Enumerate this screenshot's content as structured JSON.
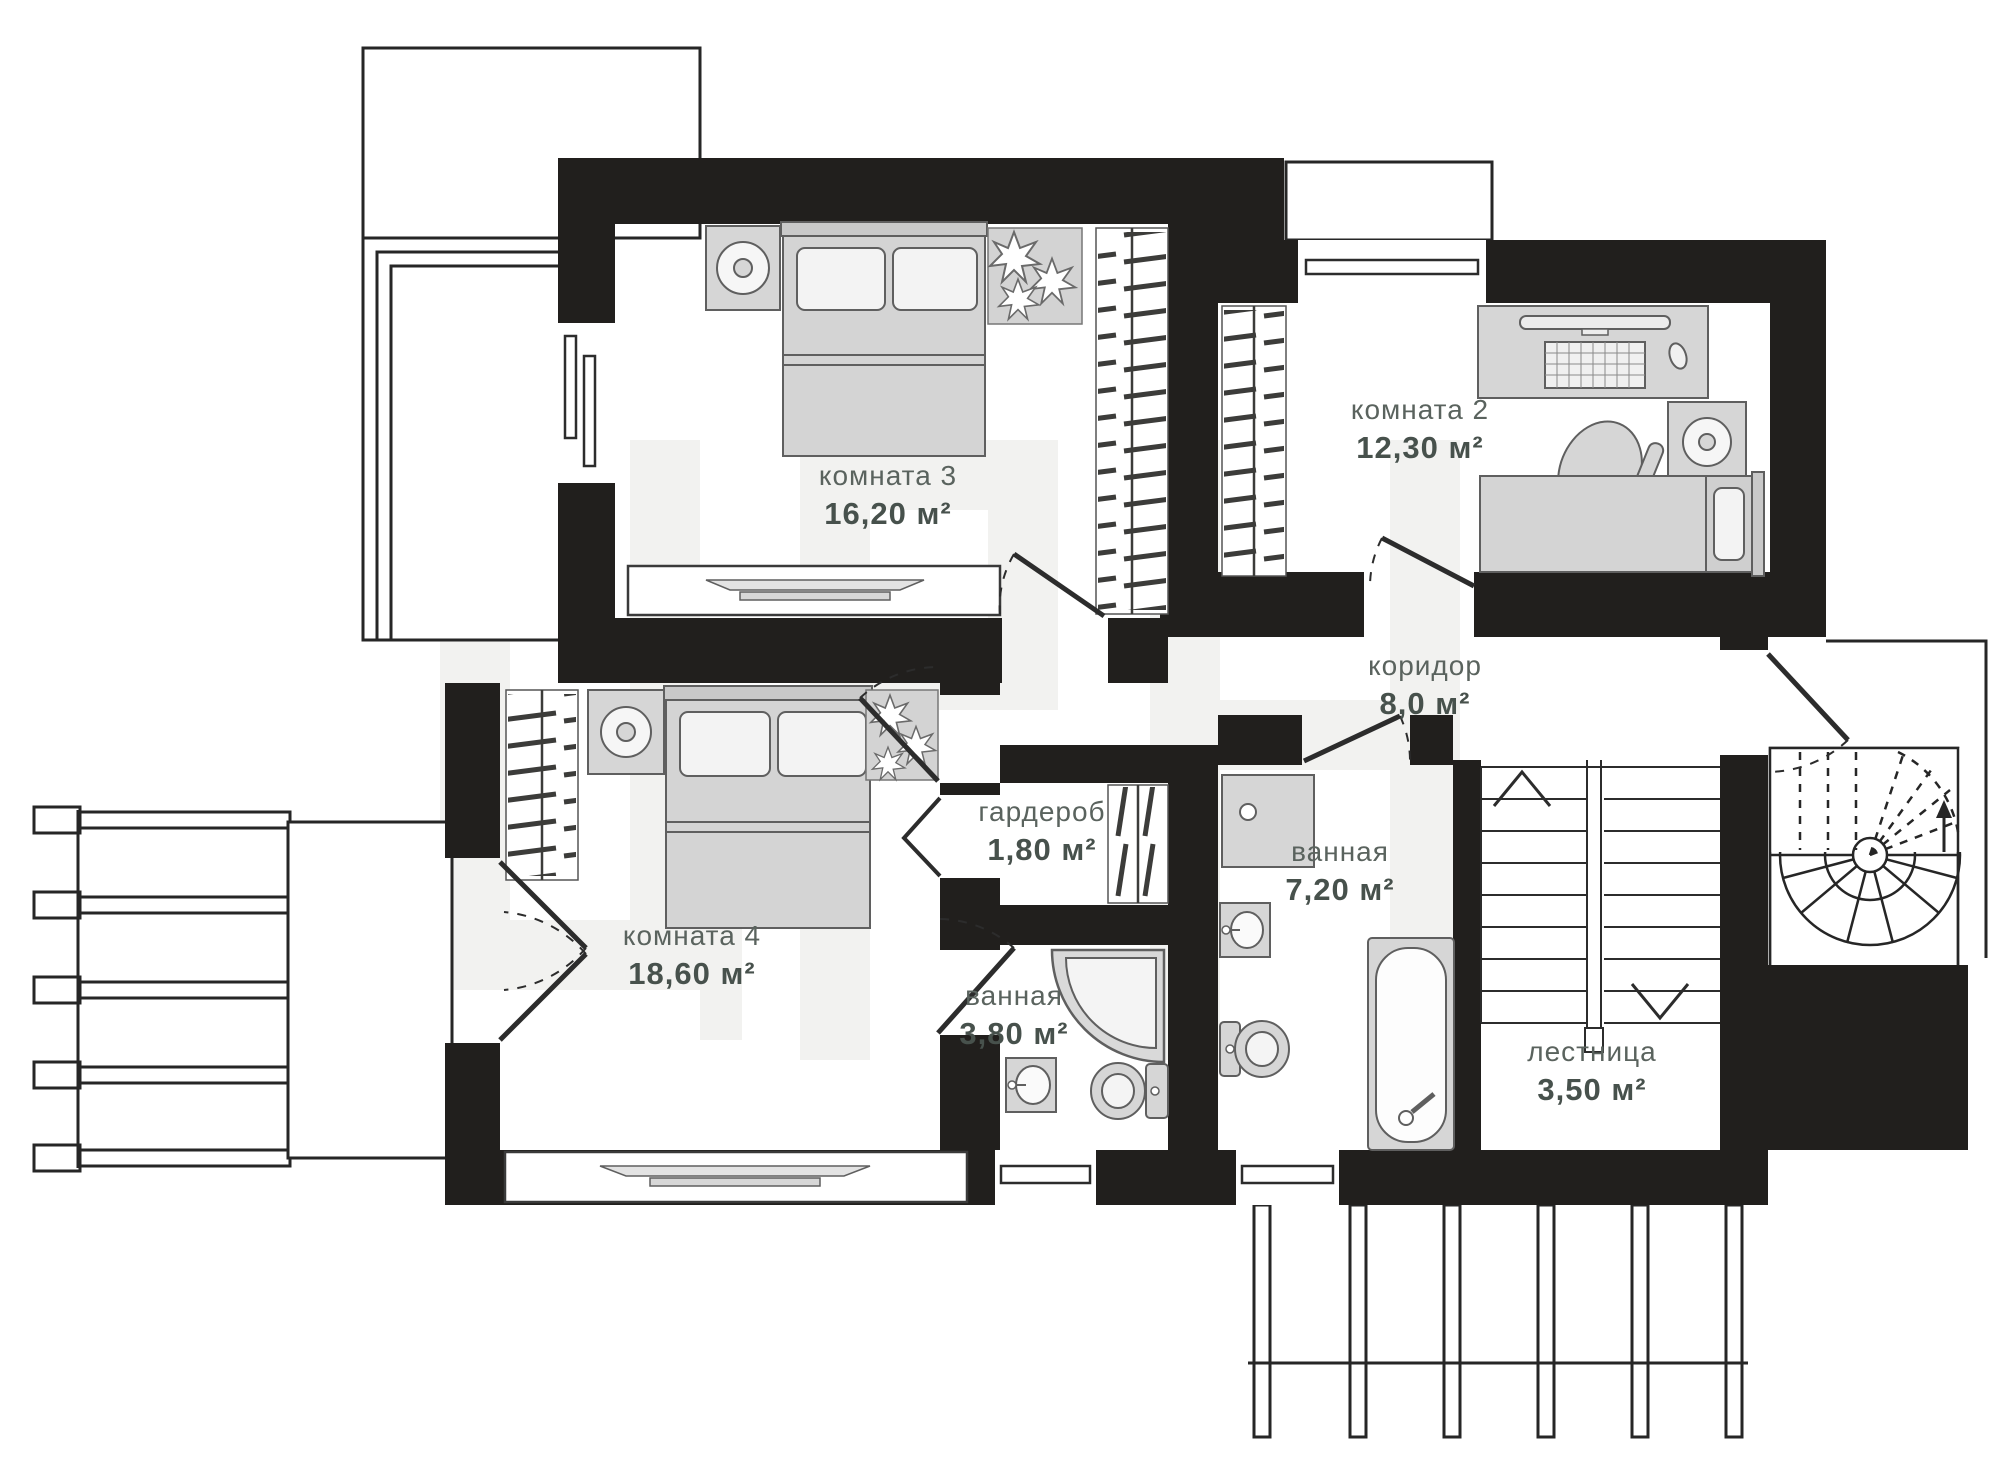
{
  "plan": {
    "type": "floor-plan",
    "language": "ru",
    "rooms": [
      {
        "id": "room-3",
        "label": "комната 3",
        "area": "16,20 м²"
      },
      {
        "id": "room-2",
        "label": "комната 2",
        "area": "12,30 м²"
      },
      {
        "id": "corridor",
        "label": "коридор",
        "area": "8,0 м²"
      },
      {
        "id": "wardrobe",
        "label": "гардероб",
        "area": "1,80 м²"
      },
      {
        "id": "bathroom-small",
        "label": "ванная",
        "area": "3,80 м²"
      },
      {
        "id": "bathroom-large",
        "label": "ванная",
        "area": "7,20 м²"
      },
      {
        "id": "room-4",
        "label": "комната 4",
        "area": "18,60 м²"
      },
      {
        "id": "stairs",
        "label": "лестница",
        "area": "3,50 м²"
      }
    ],
    "colors": {
      "wall": "#211f1d",
      "label_name": "#5a635e",
      "label_area": "#47514c",
      "furniture_fill": "#d6d6d6",
      "furniture_stroke": "#5f5f5f",
      "watermark": "#f2f2f0"
    }
  }
}
